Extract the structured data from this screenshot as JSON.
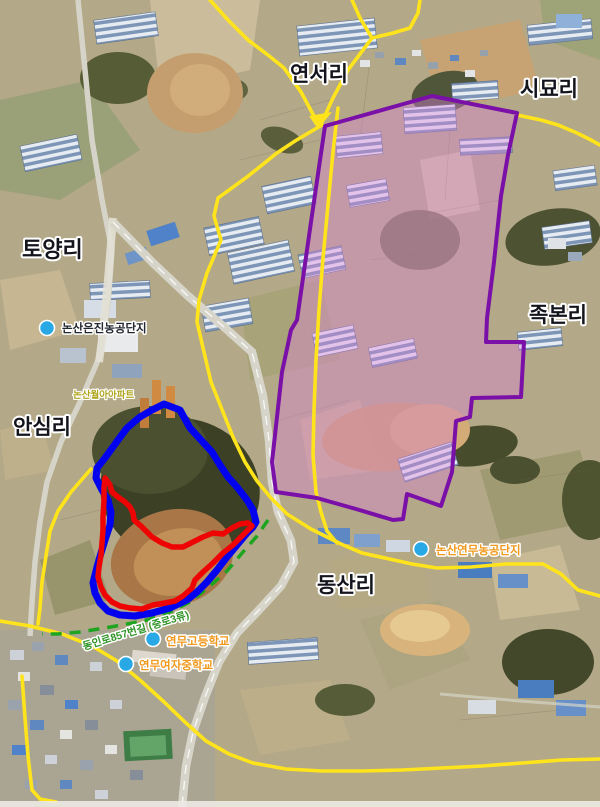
{
  "map": {
    "regions": [
      {
        "name": "yeonseo-ri",
        "label": "연서리"
      },
      {
        "name": "simyo-ri",
        "label": "시묘리"
      },
      {
        "name": "toyang-ri",
        "label": "토양리"
      },
      {
        "name": "ansim-ri",
        "label": "안심리"
      },
      {
        "name": "jukbon-ri",
        "label": "족본리"
      },
      {
        "name": "dongsan-ri",
        "label": "동산리"
      }
    ],
    "pois": [
      {
        "name": "nonsan-eunjin-agro-complex",
        "label": "논산은진농공단지",
        "label_color": "#23272f"
      },
      {
        "name": "nonsan-yeonmu-agro-complex",
        "label": "논산연무농공단지",
        "label_color": "#f0991c"
      },
      {
        "name": "yeonmu-high-school",
        "label": "연무고등학교",
        "label_color": "#f0991c"
      },
      {
        "name": "yeonmu-girls-middle-school",
        "label": "연무여자중학교",
        "label_color": "#f0991c"
      }
    ],
    "minor_labels": [
      {
        "name": "apartment",
        "label": "논산월아아파트",
        "color": "#b0a51e"
      }
    ],
    "road_labels": [
      {
        "name": "dongin-ro-857",
        "label": "동인로857번길 (중로3류)",
        "color": "#2f9427"
      }
    ],
    "overlays": {
      "purple_zone": {
        "stroke": "#7a10a8",
        "fill": "rgba(224,128,220,0.38)"
      },
      "blue_zone": {
        "stroke": "#0202ee"
      },
      "red_zone": {
        "stroke": "#ee0404"
      },
      "green_dashed_road": {
        "stroke": "#1da520"
      },
      "yellow_road": {
        "stroke": "#ffe41c"
      },
      "poi_marker": {
        "fill": "#29a8e6"
      }
    }
  }
}
